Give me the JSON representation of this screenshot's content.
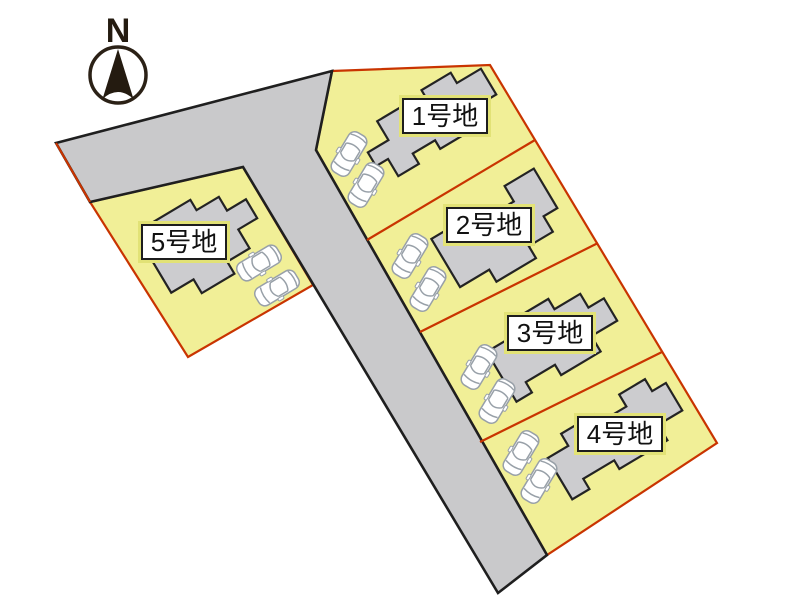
{
  "compass": {
    "north_label": "N"
  },
  "lots": [
    {
      "id": 1,
      "label": "1号地"
    },
    {
      "id": 2,
      "label": "2号地"
    },
    {
      "id": 3,
      "label": "3号地"
    },
    {
      "id": 4,
      "label": "4号地"
    },
    {
      "id": 5,
      "label": "5号地"
    }
  ],
  "colors": {
    "background": "#ffffff",
    "lot_fill": "#f1ef97",
    "road_fill": "#c9c9cb",
    "house_fill": "#cccccf",
    "boundary_red": "#c93400",
    "line_black": "#1f1f1f",
    "label_rim": "#e2e276",
    "label_fill": "#ffffff",
    "car_body": "#ffffff",
    "car_outline": "#98a0a8"
  }
}
